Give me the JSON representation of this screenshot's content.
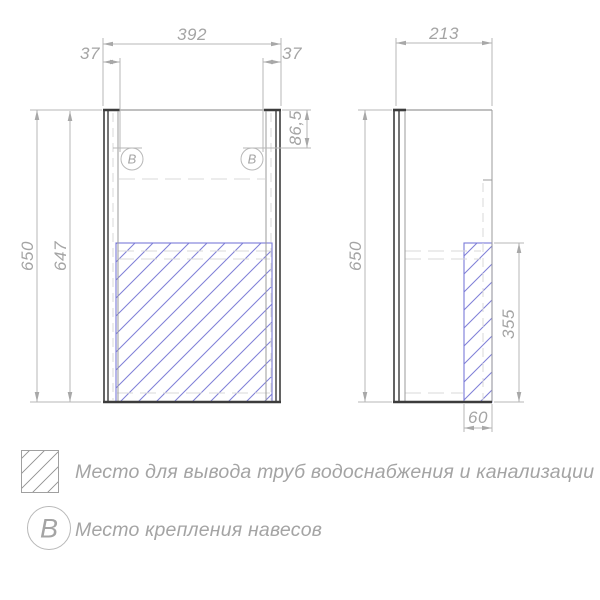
{
  "colors": {
    "bg": "#ffffff",
    "line-dark": "#3c3c3c",
    "line-grey": "#9b9b9b",
    "line-dim": "#b7b7b7",
    "line-dashed": "#d8d8d8",
    "hatch-blue": "#7b7bd8",
    "text-grey": "#a4a4a4"
  },
  "front_view": {
    "dim_width": "392",
    "dim_offset_left": "37",
    "dim_offset_right": "37",
    "dim_height_outer": "650",
    "dim_height_inner": "647",
    "dim_hinge_top": "86,5",
    "balloon_left": "В",
    "balloon_right": "В"
  },
  "side_view": {
    "dim_depth": "213",
    "dim_height": "650",
    "dim_hatch_height": "355",
    "dim_hatch_depth": "60"
  },
  "legend": {
    "items": [
      {
        "symbol": "hatch-swatch",
        "label": "Место для вывода труб водоснабжения и канализации"
      },
      {
        "symbol": "В",
        "label": "Место крепления навесов"
      }
    ]
  }
}
